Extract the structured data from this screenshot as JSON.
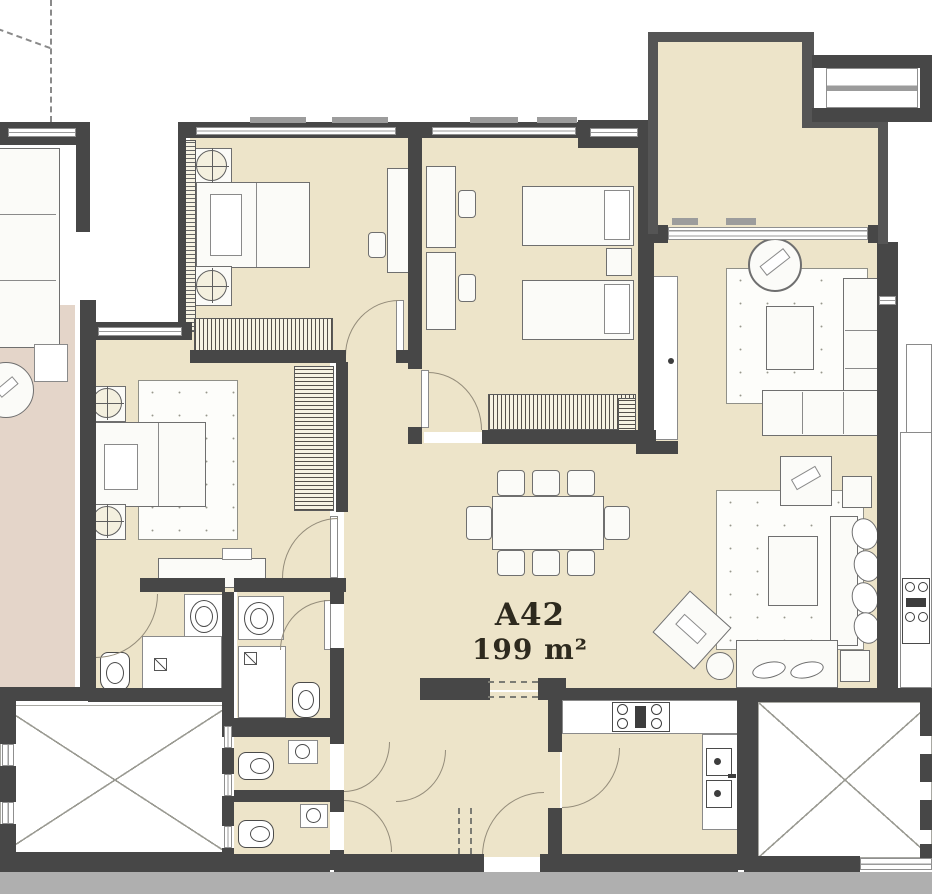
{
  "unit": {
    "label": "A42",
    "area": "199 m²"
  },
  "colors": {
    "apartment_floor": "#EDE4C9",
    "neighbor_floor_pink": "#E4D5C9",
    "wall": "#474747",
    "furniture_outline": "#6F6F6F",
    "ground_strip": "#AFAFAF",
    "label_text": "#2E2A1E"
  }
}
